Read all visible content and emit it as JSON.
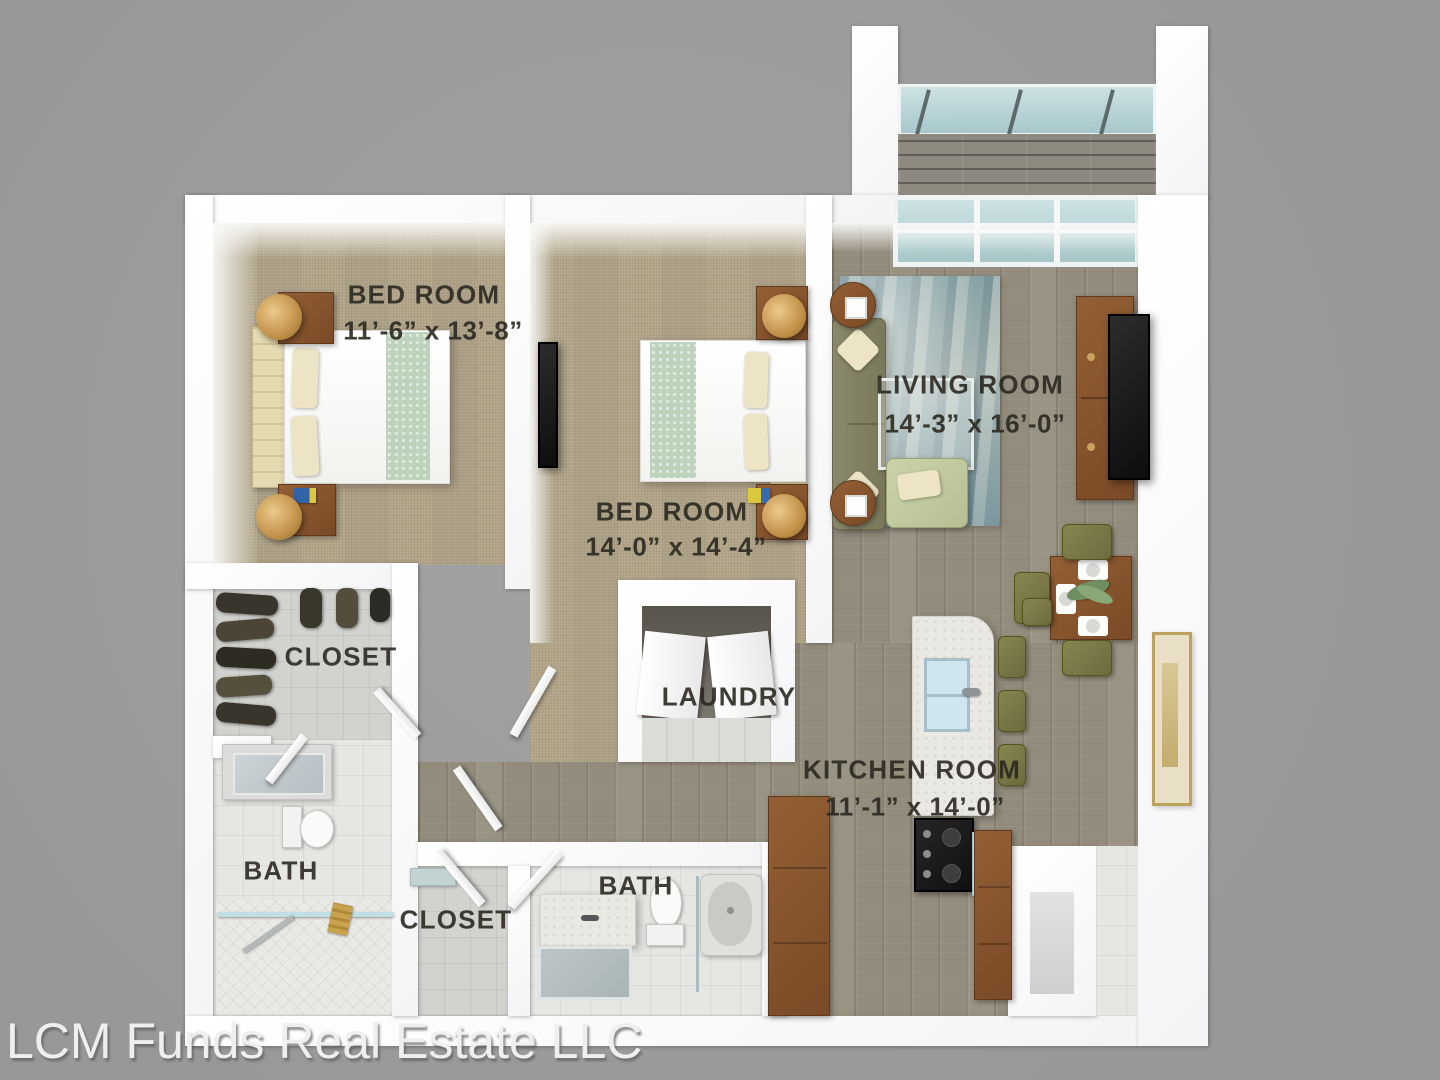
{
  "watermark": {
    "text": "LCM Funds Real Estate LLC"
  },
  "rooms": {
    "bedroom1": {
      "label": "BED ROOM",
      "dims": "11’-6” x 13’-8”"
    },
    "bedroom2": {
      "label": "BED ROOM",
      "dims": "14’-0” x 14’-4”"
    },
    "living": {
      "label": "LIVING ROOM",
      "dims": "14’-3” x 16’-0”"
    },
    "kitchen": {
      "label": "KITCHEN ROOM",
      "dims": "11’-1” x 14’-0”"
    },
    "laundry": {
      "label": "LAUNDRY"
    },
    "closet_main": {
      "label": "CLOSET"
    },
    "bath_main": {
      "label": "BATH"
    },
    "closet_hall": {
      "label": "CLOSET"
    },
    "bath_hall": {
      "label": "BATH"
    }
  },
  "colors": {
    "background": "#9d9d9d",
    "wall": "#fbfbfb",
    "carpet": "#b1a489",
    "wood_floor": "#938c7c",
    "tile": "#d2d2cf",
    "rug": "#9fb3b2",
    "sofa": "#83815f",
    "furniture_wood": "#8a5a32",
    "label_text": "#2a2820"
  }
}
